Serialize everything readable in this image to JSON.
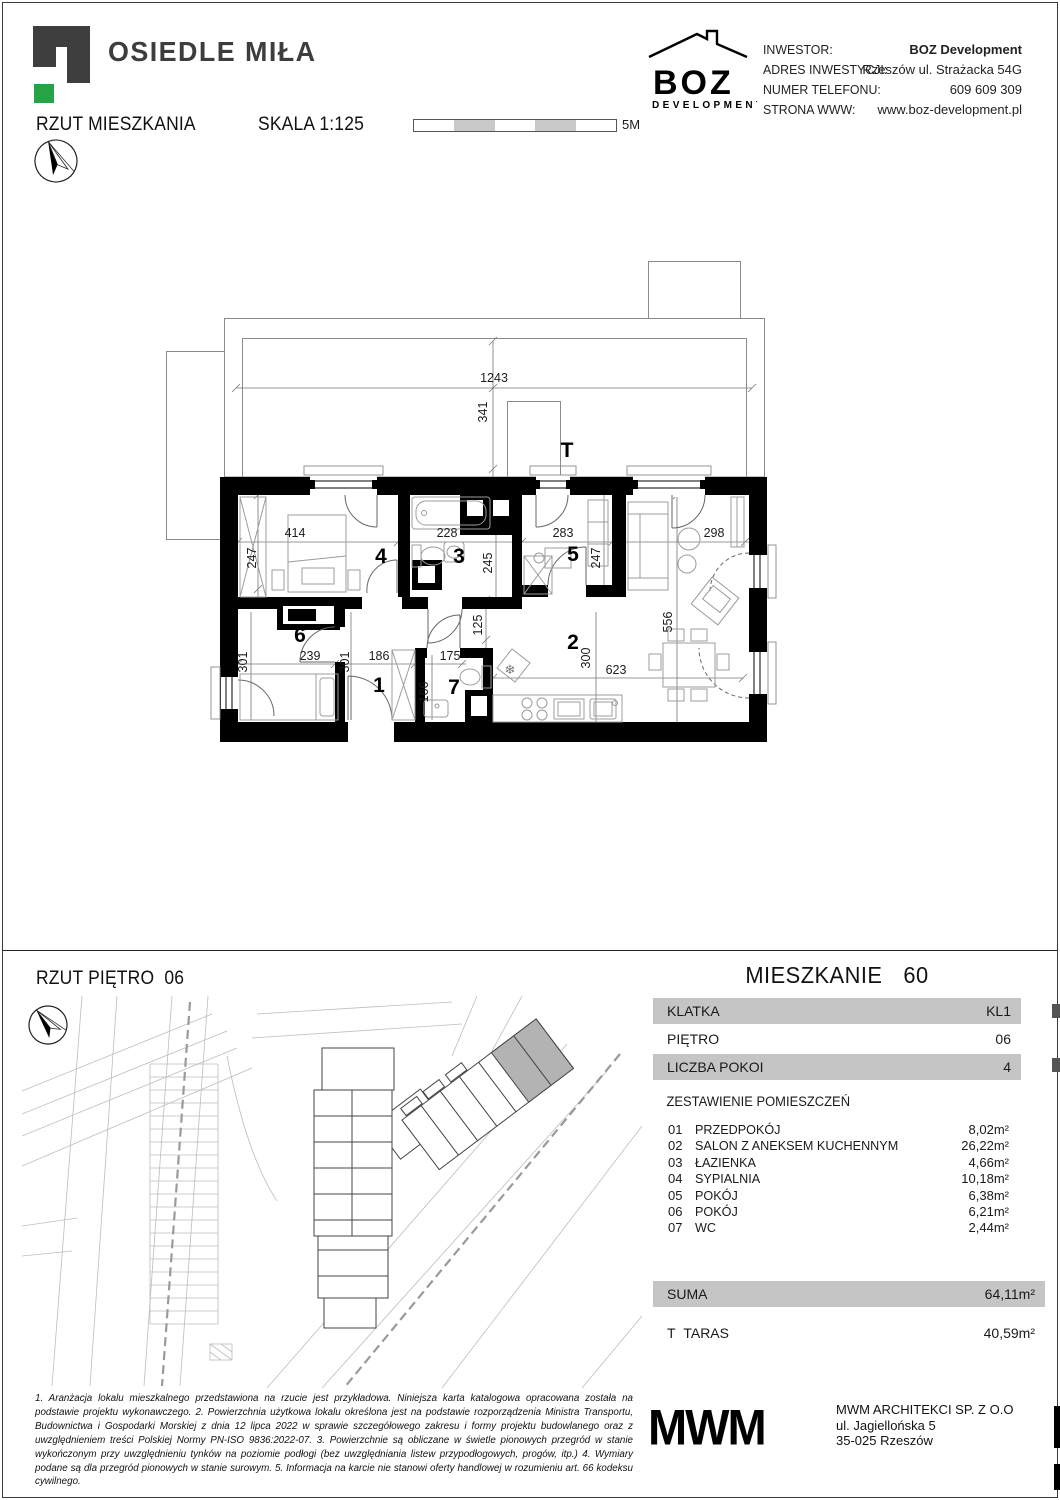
{
  "header": {
    "brand": "OSIEDLE MIŁA",
    "doc_title": "RZUT MIESZKANIA",
    "scale_label": "SKALA 1:125",
    "bar_label": "5M",
    "boz_name": "BOZ",
    "boz_sub": "DEVELOPMENT",
    "inv_l": "INWESTOR:",
    "inv_v": "BOZ Development",
    "adr_l": "ADRES INWESTYCJI:",
    "adr_v": "Rzeszów ul. Strażacka 54G",
    "tel_l": "NUMER TELEFONU:",
    "tel_v": "609 609 309",
    "www_l": "STRONA WWW:",
    "www_v": "www.boz-development.pl"
  },
  "plan": {
    "t_label": "T",
    "snowflake": "❄",
    "dims": {
      "d1243": "1243",
      "d341": "341",
      "d414": "414",
      "d247a": "247",
      "d228": "228",
      "d245": "245",
      "d283": "283",
      "d247b": "247",
      "d298": "298",
      "d125": "125",
      "d556": "556",
      "d239": "239",
      "d301a": "301",
      "d301b": "301",
      "d186": "186",
      "d175": "175",
      "d166": "166",
      "d300": "300",
      "d623": "623"
    },
    "rooms": {
      "r1": "1",
      "r2": "2",
      "r3": "3",
      "r4": "4",
      "r5": "5",
      "r6": "6",
      "r7": "7"
    }
  },
  "site": {
    "title_label": "RZUT PIĘTRO",
    "title_value": "06"
  },
  "apartment": {
    "title_label": "MIESZKANIE",
    "title_value": "60",
    "rows": [
      {
        "label": "KLATKA",
        "value": "KL1"
      },
      {
        "label": "PIĘTRO",
        "value": "06"
      },
      {
        "label": "LICZBA POKOI",
        "value": "4"
      }
    ],
    "list_title": "ZESTAWIENIE POMIESZCZEŃ",
    "room_list": [
      {
        "no": "01",
        "name": "PRZEDPOKÓJ",
        "area": "8,02m²"
      },
      {
        "no": "02",
        "name": "SALON Z ANEKSEM KUCHENNYM",
        "area": "26,22m²"
      },
      {
        "no": "03",
        "name": "ŁAZIENKA",
        "area": "4,66m²"
      },
      {
        "no": "04",
        "name": "SYPIALNIA",
        "area": "10,18m²"
      },
      {
        "no": "05",
        "name": "POKÓJ",
        "area": "6,38m²"
      },
      {
        "no": "06",
        "name": "POKÓJ",
        "area": "6,21m²"
      },
      {
        "no": "07",
        "name": "WC",
        "area": "2,44m²"
      }
    ],
    "suma_label": "SUMA",
    "suma_value": "64,11m²",
    "taras_t": "T",
    "taras_label": "TARAS",
    "taras_value": "40,59m²"
  },
  "footer": {
    "notes": "1. Aranżacja lokalu mieszkalnego przedstawiona na rzucie jest przykładowa. Niniejsza karta katalogowa opracowana została na podstawie projektu wykonawczego. 2. Powierzchnia użytkowa lokalu określona jest na podstawie rozporządzenia Ministra Transportu, Budownictwa i Gospodarki Morskiej z dnia 12 lipca 2022 w sprawie szczegółowego zakresu i formy projektu budowlanego oraz z uwzględnieniem treści Polskiej Normy PN-ISO 9836:2022-07. 3. Powierzchnie są obliczane w świetle pionowych przegród w stanie wykończonym przy uwzględnieniu tynków na poziomie podłogi (bez uwzględniania listew przypodłogowych, progów, itp.) 4. Wymiary podane są dla przegród pionowych w stanie surowym. 5. Informacja na karcie nie stanowi oferty handlowej w rozumieniu art. 66 kodeksu cywilnego.",
    "mwm_logo": "MWM",
    "studio_name": "MWM ARCHITEKCI SP. Z O.O",
    "studio_addr1": "ul. Jagiellońska 5",
    "studio_addr2": "35-025 Rzeszów"
  },
  "colors": {
    "logo_gray": "#3e3e3e",
    "logo_green": "#27a347",
    "shaded_row": "#c5c5c5",
    "site_highlight": "#b3b3b3"
  }
}
